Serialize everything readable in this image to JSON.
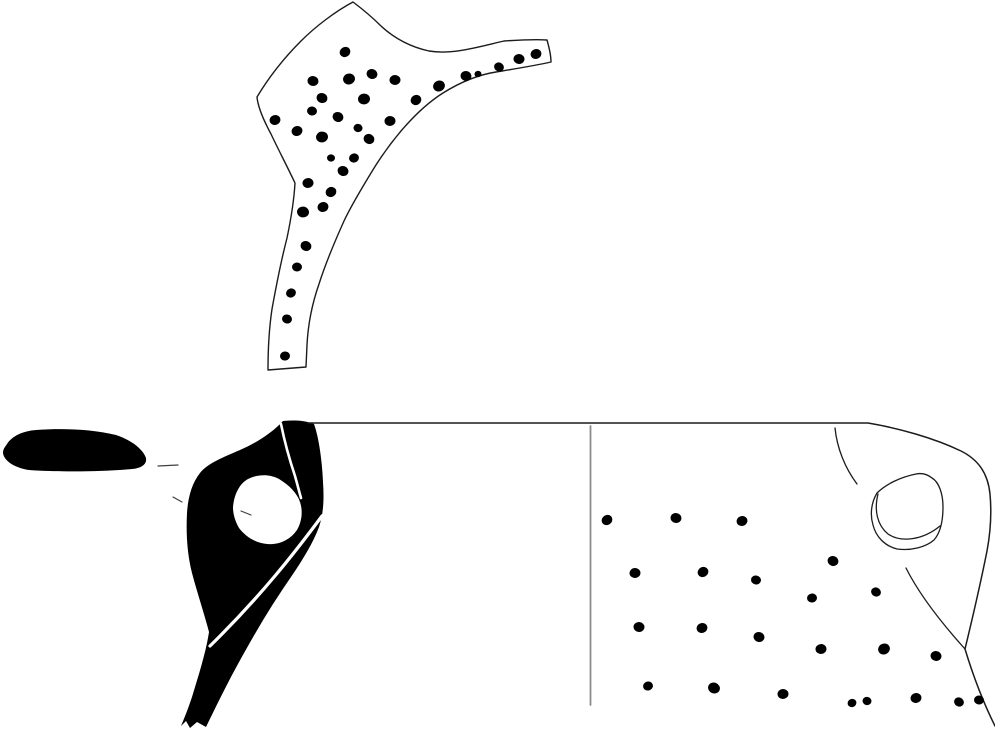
{
  "figure": {
    "canvas": {
      "width": 995,
      "height": 730
    },
    "colors": {
      "background": "#ffffff",
      "ink": "#000000",
      "outline": "#1c1c1c",
      "divider": "#8c8c8c",
      "tick": "#3f3f3f",
      "white": "#ffffff"
    },
    "shapes": [
      {
        "name": "handle-sherd-outline",
        "d": "M 353,2 C 361,8 371,16 381,26 C 394,38 411,47 429,51 C 452,55 478,47 504,41 C 519,40 534,39 547,40 C 549,47 551,55 551,62 C 533,66 514,69 496,72 C 477,75 459,83 443,93 C 427,103 413,117 401,131 C 390,144 380,158 371,173 C 362,188 352,204 344,221 C 335,241 326,262 319,284 C 312,304 308,325 307,345 L 306,367 L 268,370 C 268,349 269,329 272,309 C 276,287 281,261 287,238 C 291,219 294,200 295,183 C 287,166 278,149 271,134 C 264,121 258,108 257,97 C 269,77 285,57 301,41 C 316,26 336,11 353,2 Z",
        "fill": "#ffffff",
        "stroke": "#1c1c1c",
        "width": 1.4
      },
      {
        "name": "rim-top-section",
        "d": "M 7,444 C 12,436 23,431 36,430 C 62,428 92,429 116,435 C 131,440 143,449 146,458 C 147,464 142,468 132,469 C 99,472 58,472 29,470 C 15,468 4,461 3,453 C 3,449 5,447 7,444 Z",
        "fill": "#000000"
      },
      {
        "name": "profile-section",
        "d": "M 283,421 C 272,433 256,443 240,450 C 224,457 208,463 200,473 C 192,483 188,497 187,513 C 186,533 187,553 192,573 C 197,592 204,613 209,632 C 206,652 199,674 192,697 C 188,709 184,719 181,726 L 186,721 L 190,728 L 197,722 L 206,727 C 219,700 233,672 248,646 C 262,621 277,597 293,574 C 303,559 313,543 319,527 C 324,512 324,497 323,482 C 322,461 319,438 314,424 C 304,420 293,420 283,421 Z",
        "fill": "#000000"
      },
      {
        "name": "profile-handle-hole",
        "d": "M 233,507 C 234,495 239,484 248,479 C 258,474 270,474 279,479 C 289,485 297,493 300,502 C 303,511 302,521 297,530 C 290,540 279,545 267,544 C 255,543 245,536 239,528 C 235,521 233,514 233,507 Z",
        "fill": "#ffffff"
      },
      {
        "name": "profile-rim-divider",
        "d": "M 281,424 C 285,444 290,461 295,476 C 297,483 299,491 301,498",
        "stroke": "#ffffff",
        "width": 2.6
      },
      {
        "name": "profile-handle-divider",
        "d": "M 322,516 C 296,551 262,595 210,646",
        "stroke": "#ffffff",
        "width": 3.2
      },
      {
        "name": "vessel-rim-and-right-outline",
        "d": "M 308,423 L 868,423 C 898,428 934,438 961,451 C 979,460 988,474 990,494 C 992,516 990,535 987,551 C 981,581 973,616 965,649 C 972,672 981,698 995,726",
        "stroke": "#1c1c1c",
        "width": 1.5
      },
      {
        "name": "section-elevation-divider",
        "d": "M 590.5,426 L 590.5,705",
        "stroke": "#8c8c8c",
        "width": 1.8
      },
      {
        "name": "neck-handle-curve",
        "d": "M 835,428 C 837,448 845,468 857,484",
        "stroke": "#1c1c1c",
        "width": 1.3
      },
      {
        "name": "shoulder-break-curve",
        "d": "M 906,568 C 917,590 938,619 965,649",
        "stroke": "#1c1c1c",
        "width": 1.3
      },
      {
        "name": "lug-hole-outer",
        "d": "M 916,474 C 901,477 886,484 877,493 C 871,503 870,515 873,525 C 876,537 885,546 897,549 C 911,551 926,547 934,540 C 941,532 943,520 943,507 C 943,494 939,482 932,478 C 927,474 921,473 916,474 Z",
        "stroke": "#1c1c1c",
        "width": 1.3
      },
      {
        "name": "lug-hole-inner",
        "d": "M 878,494 C 874,510 877,525 888,534 C 901,543 923,540 940,526",
        "stroke": "#1c1c1c",
        "width": 1.3
      },
      {
        "name": "tick-rim-left",
        "d": "M 158,466 L 178,465",
        "stroke": "#3f3f3f",
        "width": 1.2
      },
      {
        "name": "tick-below-rim",
        "d": "M 173,497 L 182,502",
        "stroke": "#3f3f3f",
        "width": 1.2
      },
      {
        "name": "tick-in-hole",
        "d": "M 241,511 L 251,515",
        "stroke": "#3f3f3f",
        "width": 1.2
      }
    ],
    "stipple": {
      "handle_fragment": [
        [
          345,
          52,
          5.5
        ],
        [
          313,
          81,
          5.5
        ],
        [
          349,
          79,
          6
        ],
        [
          372,
          74,
          5.5
        ],
        [
          395,
          80,
          5.5
        ],
        [
          439,
          86,
          6
        ],
        [
          466,
          76,
          5.5
        ],
        [
          478,
          74,
          3.5
        ],
        [
          499,
          67,
          5
        ],
        [
          519,
          59,
          5.5
        ],
        [
          536,
          54,
          5.5
        ],
        [
          322,
          98,
          5.5
        ],
        [
          364,
          99,
          6
        ],
        [
          416,
          100,
          5.5
        ],
        [
          312,
          111,
          5
        ],
        [
          275,
          120,
          5.5
        ],
        [
          338,
          117,
          5.5
        ],
        [
          390,
          121,
          5.5
        ],
        [
          297,
          131,
          5.5
        ],
        [
          358,
          128,
          4.5
        ],
        [
          322,
          137,
          6
        ],
        [
          369,
          139,
          5.5
        ],
        [
          331,
          158,
          4
        ],
        [
          354,
          158,
          5
        ],
        [
          343,
          171,
          5.5
        ],
        [
          308,
          183,
          5.5
        ],
        [
          331,
          192,
          5.5
        ],
        [
          303,
          212,
          6
        ],
        [
          323,
          207,
          5.5
        ],
        [
          306,
          246,
          5.5
        ],
        [
          297,
          267,
          5
        ],
        [
          291,
          293,
          5
        ],
        [
          287,
          319,
          5
        ],
        [
          285,
          356,
          5
        ]
      ],
      "body_exterior": [
        [
          607,
          520,
          5.5
        ],
        [
          676,
          518,
          5.5
        ],
        [
          742,
          521,
          5.5
        ],
        [
          833,
          561,
          5.5
        ],
        [
          635,
          573,
          5.5
        ],
        [
          703,
          572,
          5.5
        ],
        [
          756,
          580,
          5
        ],
        [
          812,
          598,
          5
        ],
        [
          876,
          592,
          5
        ],
        [
          639,
          627,
          5.5
        ],
        [
          702,
          628,
          5.5
        ],
        [
          759,
          637,
          5.5
        ],
        [
          821,
          649,
          5.5
        ],
        [
          884,
          649,
          6
        ],
        [
          936,
          656,
          5.5
        ],
        [
          648,
          686,
          5
        ],
        [
          714,
          688,
          6
        ],
        [
          783,
          694,
          5.5
        ],
        [
          852,
          703,
          4.5
        ],
        [
          867,
          701,
          4.5
        ],
        [
          916,
          698,
          5.5
        ],
        [
          959,
          702,
          5
        ],
        [
          979,
          700,
          5
        ]
      ]
    }
  }
}
